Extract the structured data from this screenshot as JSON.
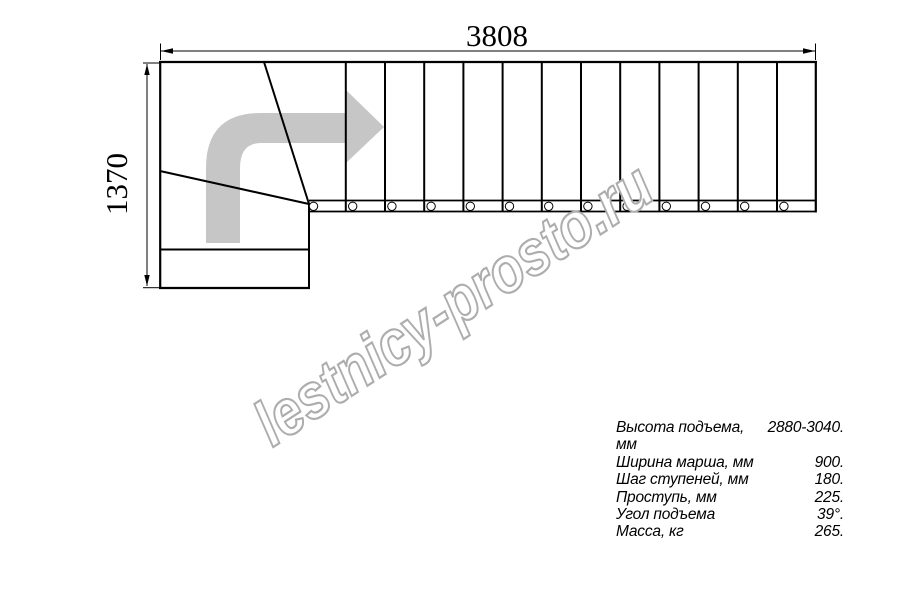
{
  "drawing": {
    "width_dim": "3808",
    "height_dim": "1370",
    "flight": {
      "step_lines": {
        "count": 12,
        "x_start": 345.8,
        "spacing": 39.2,
        "y1": 62,
        "y2": 211.5,
        "stroke_width": 2
      },
      "circles": {
        "count": 13,
        "cx_start": 313.5,
        "spacing": 39.2,
        "cy": 206.3,
        "r": 4.2
      }
    }
  },
  "watermark": {
    "text": "lestnicy-prosto.ru"
  },
  "specs": {
    "rows": [
      {
        "label": "Высота подъема, мм",
        "value": "2880-3040."
      },
      {
        "label": "Ширина марша, мм",
        "value": "900."
      },
      {
        "label": "Шаг ступеней, мм",
        "value": "180."
      },
      {
        "label": "Проступь, мм",
        "value": "225."
      },
      {
        "label": "Угол подъема",
        "value": "39°."
      },
      {
        "label": "Масса, кг",
        "value": "265."
      }
    ]
  },
  "colors": {
    "line": "#000000",
    "arrow": "#c6c6c6",
    "watermark_outline": "#adadad",
    "background": "#ffffff"
  }
}
